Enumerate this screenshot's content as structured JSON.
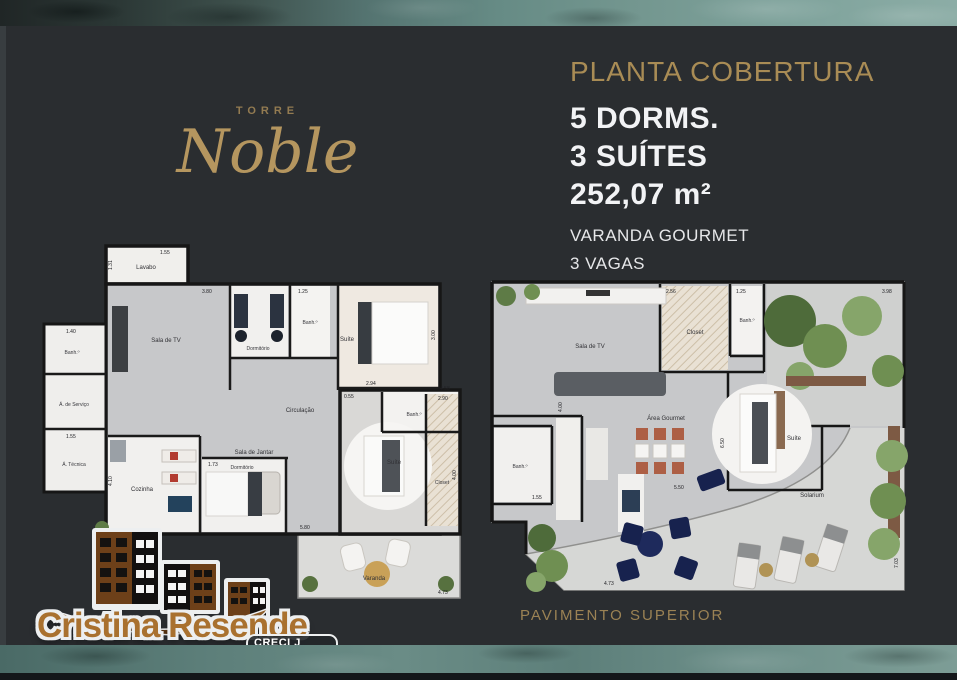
{
  "colors": {
    "background": "#2a2d30",
    "gold": "#a98c55",
    "teal": "#5d7f7a",
    "navy": "#1e2a5c",
    "logo_brown": "#a9712f"
  },
  "brand": {
    "tower_label": "TORRE",
    "tower_name": "Noble"
  },
  "header": {
    "title": "PLANTA COBERTURA",
    "specs": [
      "5 DORMS.",
      "3 SUÍTES",
      "252,07 m²"
    ],
    "features": [
      "VARANDA GOURMET",
      "3 VAGAS"
    ]
  },
  "plan_lower": {
    "rooms": [
      "Lavabo",
      "Sala de TV",
      "Dormitório",
      "Banh.º",
      "Suíte",
      "Banh.º",
      "Á. de Serviço",
      "Á. Técnica",
      "Cozinha",
      "Sala de Jantar",
      "Circulação",
      "Dormitório",
      "Banh.º",
      "Suíte",
      "Closet",
      "Varanda"
    ],
    "dims": [
      "1.55",
      "1.31",
      "3.80",
      "1.25",
      "2.94",
      "3.00",
      "2.90",
      "1.40",
      "1.55",
      "4.10",
      "5.80",
      "1.73",
      "4.58",
      "4.00",
      "4.73",
      "0.55"
    ]
  },
  "plan_upper": {
    "caption": "PAVIMENTO SUPERIOR",
    "rooms": [
      "Sala de TV",
      "Closet",
      "Banh.º",
      "Banh.º",
      "Suíte",
      "Área Gourmet",
      "Solarium"
    ],
    "dims": [
      "2.56",
      "1.25",
      "3.98",
      "1.55",
      "5.50",
      "4.73",
      "7.03",
      "4.00",
      "6.50"
    ]
  },
  "footer": {
    "logo_name": "Cristina Resende",
    "logo_subtitle": "Imóveis",
    "creci": "CRECI J 25928"
  }
}
